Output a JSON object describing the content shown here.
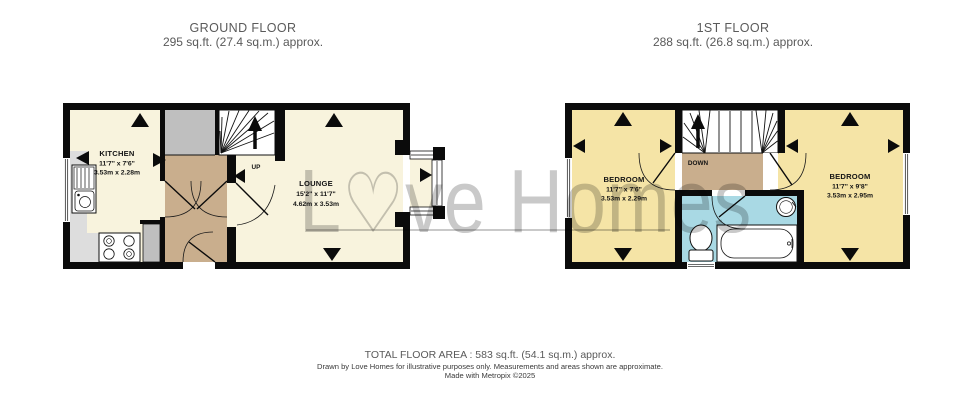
{
  "headers": {
    "ground": {
      "title": "GROUND FLOOR",
      "area": "295 sq.ft. (27.4 sq.m.) approx."
    },
    "first": {
      "title": "1ST FLOOR",
      "area": "288 sq.ft. (26.8 sq.m.) approx."
    }
  },
  "ground_floor": {
    "kitchen": {
      "name": "KITCHEN",
      "imperial": "11'7\" x 7'6\"",
      "metric": "3.53m x 2.28m"
    },
    "lounge": {
      "name": "LOUNGE",
      "imperial": "15'2\" x 11'7\"",
      "metric": "4.62m x 3.53m"
    },
    "stairs_label": "UP"
  },
  "first_floor": {
    "bedroom_left": {
      "name": "BEDROOM",
      "imperial": "11'7\" x 7'6\"",
      "metric": "3.53m x 2.29m"
    },
    "bedroom_right": {
      "name": "BEDROOM",
      "imperial": "11'7\" x 9'8\"",
      "metric": "3.53m x 2.95m"
    },
    "stairs_label": "DOWN"
  },
  "watermark": {
    "pre": "L",
    "heart": "♡",
    "post": "ve Homes"
  },
  "footer": {
    "total_area": "TOTAL FLOOR AREA : 583 sq.ft. (54.1 sq.m.) approx.",
    "disclaimer": "Drawn by Love Homes for illustrative purposes only. Measurements and areas shown are approximate.",
    "credit": "Made with Metropix ©2025"
  },
  "colors": {
    "wall": "#0b0b0b",
    "room_ground": "#f8f3dd",
    "room_first": "#f5e4a6",
    "hall": "#c9ae8d",
    "bathroom": "#a9d9e4",
    "vestibule": "#bfbfbf",
    "counter": "#dddddd",
    "watermark": "#c9c9c9"
  }
}
